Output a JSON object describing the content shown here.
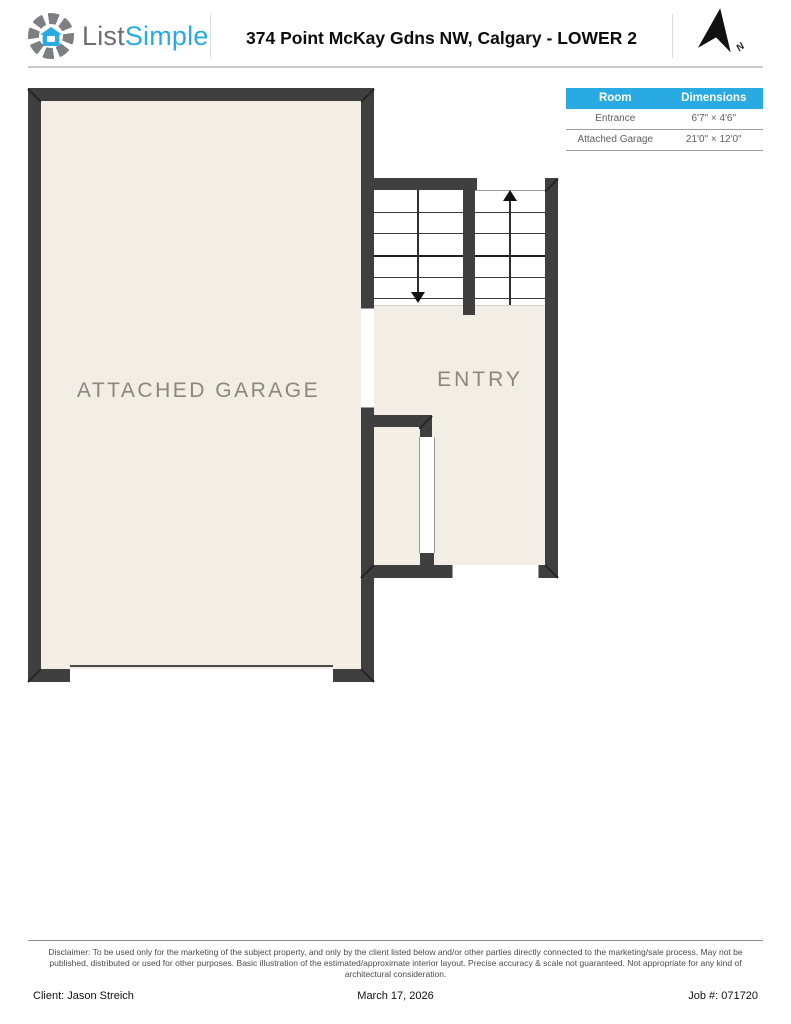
{
  "header": {
    "logo": {
      "icon": "aperture-house-icon",
      "text_gray": "List",
      "text_accent": "Simple"
    },
    "title": "374 Point McKay Gdns NW, Calgary - LOWER 2",
    "north_label": "N"
  },
  "room_table": {
    "columns": [
      "Room",
      "Dimensions"
    ],
    "rows": [
      {
        "room": "Entrance",
        "dimensions": "6'7\" × 4'6\""
      },
      {
        "room": "Attached Garage",
        "dimensions": "21'0\" × 12'0\""
      }
    ]
  },
  "floor_plan": {
    "rooms": [
      {
        "label": "ATTACHED GARAGE"
      },
      {
        "label": "ENTRY"
      }
    ],
    "stairs": {
      "down_arrow": "down",
      "up_arrow": "up"
    }
  },
  "footer": {
    "disclaimer_lines": [
      "Disclaimer: To be used only for the marketing of the subject property, and only by the client listed below and/or other parties directly connected to the marketing/sale process. May not be",
      "published, distributed or used for other purposes. Basic illustration of the estimated/approximate interior layout. Precise accuracy & scale not guaranteed. Not appropriate for any kind of",
      "architectural consideration."
    ],
    "client": "Client: Jason Streich",
    "date": "March 17, 2026",
    "job": "Job #: 071720"
  },
  "colors": {
    "accent": "#29ABE2",
    "wall": "#3F3F3F",
    "floor": "#F3EEE5",
    "room_label": "#8B867F"
  }
}
